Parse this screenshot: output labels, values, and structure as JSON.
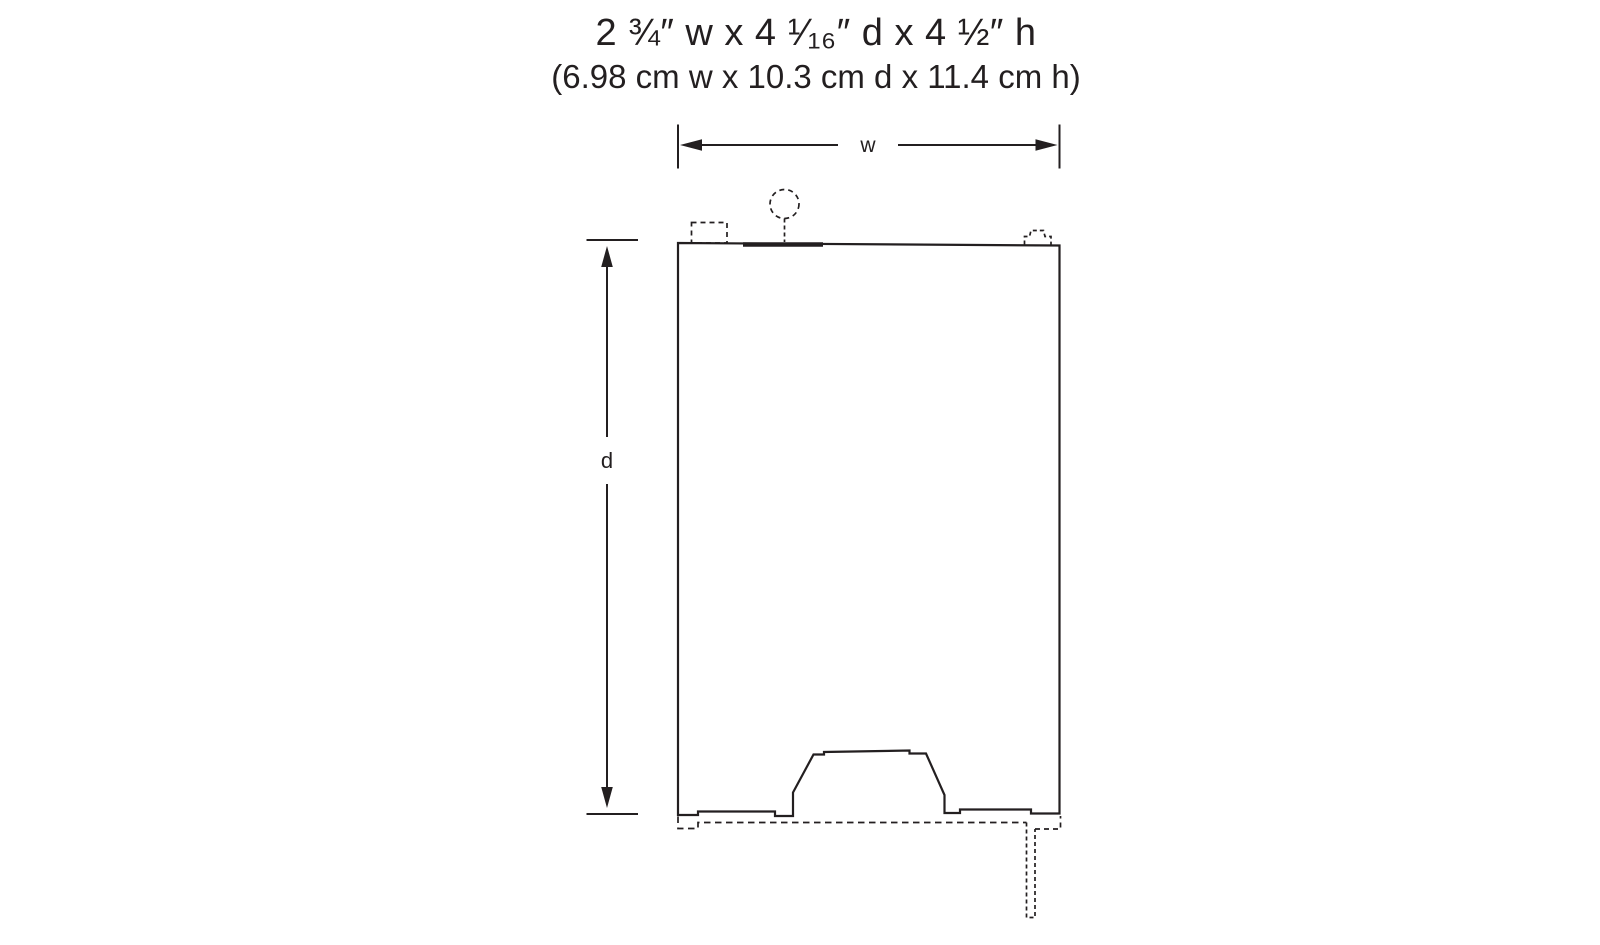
{
  "title": {
    "imperial": "2 ¾″ w x 4 ¹⁄₁₆″ d x 4 ½″ h",
    "metric": "(6.98 cm w x 10.3 cm d x 11.4 cm h)"
  },
  "dimension_labels": {
    "width": "w",
    "depth": "d"
  },
  "colors": {
    "line": "#231f20",
    "background": "#ffffff"
  }
}
